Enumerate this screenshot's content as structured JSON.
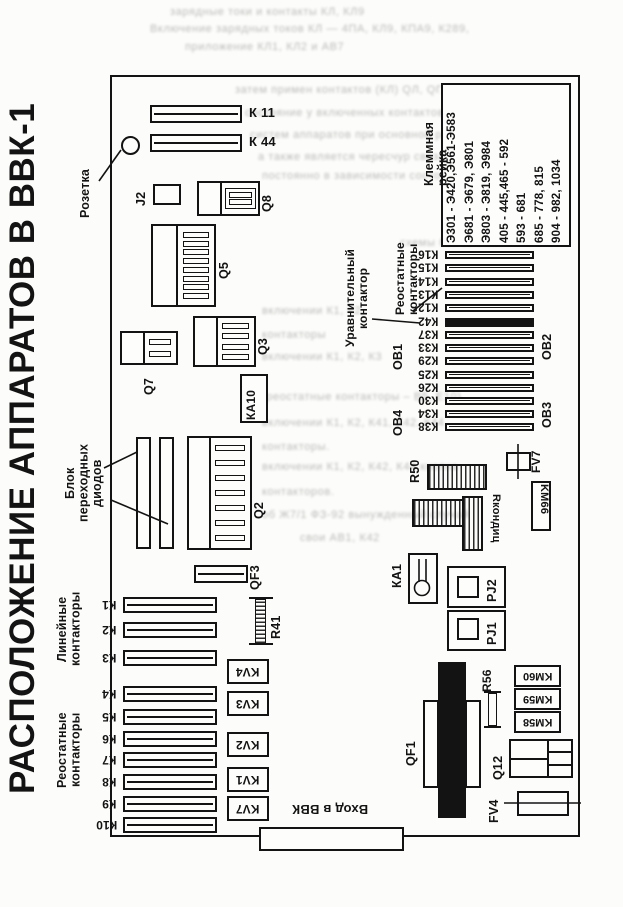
{
  "title": "РАСПОЛОЖЕНИЕ АППАРАТОВ В ВВК-1",
  "top": {
    "k11": "К 11",
    "k44": "К 44",
    "rozetka": "Розетка",
    "j2": "J2",
    "q8": "Q8"
  },
  "components": {
    "q5": "Q5",
    "q7": "Q7",
    "q3": "Q3",
    "ka10": "КА10",
    "q2": "Q2",
    "qf3": "QF3",
    "r41": "R41",
    "r50": "R50",
    "r_kondits": "Rкондиц",
    "km66": "KM66",
    "fv7": "FV7",
    "ka1": "КА1",
    "pj1": "PJ1",
    "pj2": "PJ2",
    "qf1": "QF1",
    "r56": "R56",
    "km58": "KM58",
    "km59": "KM59",
    "km60": "KM60",
    "q12": "Q12",
    "fv4": "FV4",
    "vhod_v_bbk": "Вход в ВВК"
  },
  "group_labels": {
    "diode_block": "Блок переходных\nдиодов",
    "linear": "Линейные\nконтакторы",
    "rheostat_left": "Реостатные\nконтакторы",
    "rheostat_right": "Реостатные\nконтакторы",
    "equalizing": "Уравнительный\nконтактор",
    "ob1": "ОВ1",
    "ob2": "ОВ2",
    "ob3": "ОВ3",
    "ob4": "ОВ4"
  },
  "terminal_rail": {
    "label": "Клеммная рейка",
    "lines": [
      "Э301 - Э420,Э561-Э583",
      "Э681 - Э679, Э801",
      "Э803 - Э819, Э984",
      "405 - 445,465 - 592",
      "593 - 681",
      "685 - 778, 815",
      "904 - 982, 1034"
    ]
  },
  "left_bars": [
    "К1",
    "К2",
    "К3",
    "К4",
    "К5",
    "К6",
    "К7",
    "К8",
    "К9",
    "К10"
  ],
  "right_bars": [
    "К16",
    "К15",
    "К14",
    "К13",
    "К12",
    "К42",
    "К37",
    "К33",
    "К29",
    "К25",
    "К26",
    "К30",
    "К34",
    "К38"
  ],
  "kv_boxes": [
    "KV4",
    "KV3",
    "KV2",
    "KV1",
    "KV7"
  ],
  "bleed_text": [
    "зарядные токи и контакты КЛ, КЛ9",
    "Включение зарядных токов КЛ — 4ПА, КЛ9, КПА9, К289,",
    "приложение КЛ1, КЛ2 и АВ7",
    "затем примен контактов (КЛ) QЛ, QГ, через которые",
    "состояние у включенных контактов при переключении",
    "систем аппаратов при основной рабочей смене",
    "а также является чересчур связанным",
    "постоянно в зависимости состояния цепи",
    "схемы без выемки",
    "включении К1, К2,",
    "контакторы",
    "включении К1, К2, К3",
    "(реостатные контакторы – В5, Е10)",
    "включении К1, К2, К41, К42, К44",
    "контакторы.",
    "включении К1, К2, К42, К44 кнопка",
    "контакторов.",
    "об Ж7/1 ФЗ-92 вынужденный случай",
    "свои АВ1, К42"
  ]
}
